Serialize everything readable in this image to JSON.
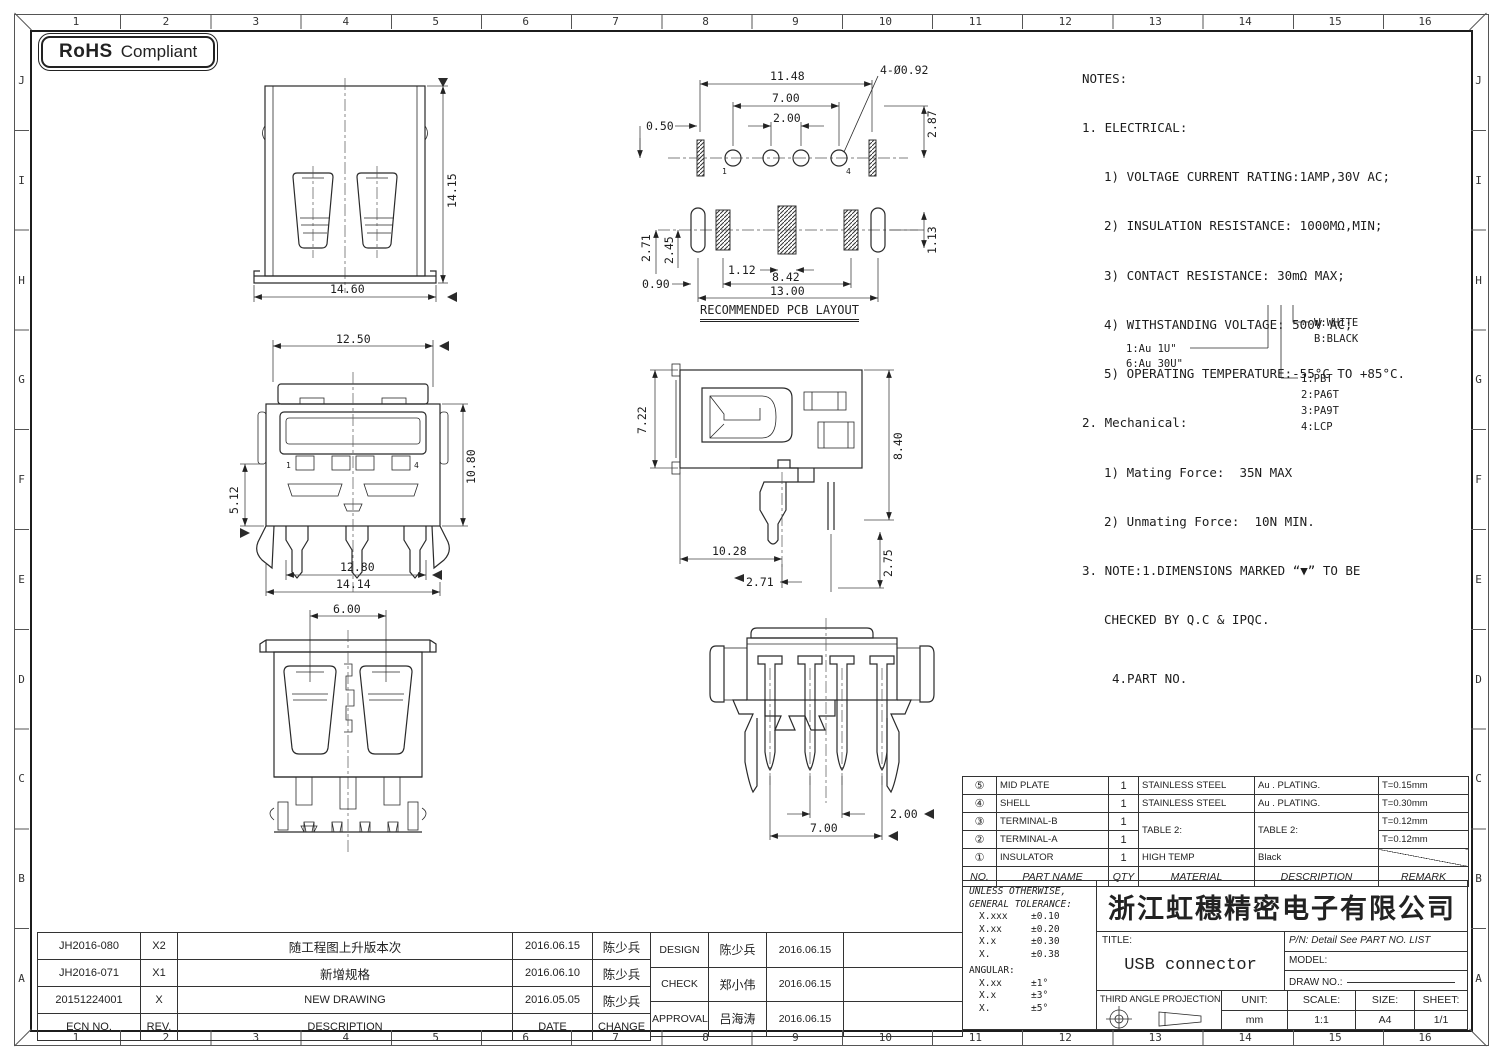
{
  "badge": {
    "bold": "RoHS",
    "rest": "Compliant"
  },
  "grid": {
    "cols": [
      "1",
      "2",
      "3",
      "4",
      "5",
      "6",
      "7",
      "8",
      "9",
      "10",
      "11",
      "12",
      "13",
      "14",
      "15",
      "16"
    ],
    "rows": [
      "J",
      "I",
      "H",
      "G",
      "F",
      "E",
      "D",
      "C",
      "B",
      "A"
    ]
  },
  "glyphs": {
    "down": "▼",
    "left": "◀",
    "right": "▶"
  },
  "notes": {
    "lines": [
      "NOTES:",
      "1. ELECTRICAL:",
      "1) VOLTAGE CURRENT RATING:1AMP,30V AC;",
      "2) INSULATION RESISTANCE: 1000MΩ,MIN;",
      "3) CONTACT RESISTANCE: 30mΩ MAX;",
      "4) WITHSTANDING VOLTAGE: 500V AC;",
      "5) OPERATING TEMPERATURE:-55°C TO +85°C.",
      "2. Mechanical:",
      "1) Mating Force:  35N MAX",
      "2) Unmating Force:  10N MIN.",
      "3. NOTE:1.DIMENSIONS MARKED “▼” TO BE",
      "CHECKED BY Q.C & IPQC.",
      "4.PART NO."
    ]
  },
  "legend": {
    "au1": "1:Au 1U\"",
    "au6": "6:Au 30U\"",
    "white": "W:WHITE",
    "black": "B:BLACK",
    "m1": "1:PBT",
    "m2": "2:PA6T",
    "m3": "3:PA9T",
    "m4": "4:LCP"
  },
  "views": {
    "front": {
      "height": "14.15",
      "width": "14.60"
    },
    "pcb": {
      "label": "RECOMMENDED PCB LAYOUT",
      "d1": "11.48",
      "d2": "7.00",
      "d3": "2.00",
      "d4": "0.50",
      "d5": "2.87",
      "callout": "4-Ø0.92",
      "d6": "2.71",
      "d7": "2.45",
      "d8": "0.90",
      "d9": "1.12",
      "d10": "8.42",
      "d11": "13.00",
      "d12": "1.13",
      "pin1": "1",
      "pin4": "4"
    },
    "front2": {
      "d1": "12.50",
      "d2": "10.80",
      "d3": "5.12",
      "d4": "12.80",
      "d5": "14.14",
      "pin1": "1",
      "pin4": "4"
    },
    "side": {
      "d1": "7.22",
      "d2": "8.40",
      "d3": "10.28",
      "d4": "2.71",
      "d5": "2.75"
    },
    "rear": {
      "d1": "6.00"
    },
    "bottom": {
      "d1": "2.00",
      "d2": "7.00"
    }
  },
  "parts_table": {
    "header": {
      "no": "NO.",
      "part_name": "PART NAME",
      "qty": "QTY",
      "material": "MATERIAL",
      "description": "DESCRIPTION",
      "remark": "REMARK"
    },
    "rows": [
      {
        "no": "⑤",
        "part_name": "MID PLATE",
        "qty": "1",
        "material": "STAINLESS STEEL",
        "description": "Au . PLATING.",
        "remark": "T=0.15mm"
      },
      {
        "no": "④",
        "part_name": "SHELL",
        "qty": "1",
        "material": "STAINLESS STEEL",
        "description": "Au . PLATING.",
        "remark": "T=0.30mm"
      },
      {
        "no": "③",
        "part_name": "TERMINAL-B",
        "qty": "1",
        "material": "TABLE 2:",
        "description": "TABLE 2:",
        "remark": "T=0.12mm"
      },
      {
        "no": "②",
        "part_name": "TERMINAL-A",
        "qty": "1",
        "remark": "T=0.12mm"
      },
      {
        "no": "①",
        "part_name": "INSULATOR",
        "qty": "1",
        "material": "HIGH TEMP",
        "description": "Black",
        "remark": ""
      }
    ]
  },
  "title_block": {
    "company": "浙江虹穗精密电子有限公司",
    "tolerance": {
      "line1": "UNLESS OTHERWISE,",
      "line2": "GENERAL TOLERANCE:",
      "rows": [
        [
          "X.xxx",
          "±0.10"
        ],
        [
          "X.xx",
          "±0.20"
        ],
        [
          "X.x",
          "±0.30"
        ],
        [
          "X.",
          "±0.38"
        ]
      ],
      "angular_label": "ANGULAR:",
      "angular_rows": [
        [
          "X.xx",
          "±1°"
        ],
        [
          "X.x",
          "±3°"
        ],
        [
          "X.",
          "±5°"
        ]
      ]
    },
    "title_label": "TITLE:",
    "title_value": "USB connector",
    "pn": "P/N: Detail See PART NO. LIST",
    "model_label": "MODEL:",
    "draw_no_label": "DRAW NO.:",
    "projection_label": "THIRD ANGLE PROJECTION",
    "unit_label": "UNIT:",
    "unit_value": "mm",
    "scale_label": "SCALE:",
    "scale_value": "1:1",
    "size_label": "SIZE:",
    "size_value": "A4",
    "sheet_label": "SHEET:",
    "sheet_value": "1/1"
  },
  "revision_table": {
    "header": {
      "ecn": "ECN NO.",
      "rev": "REV.",
      "desc": "DESCRIPTION",
      "date": "DATE",
      "change": "CHANGE"
    },
    "rows": [
      {
        "ecn": "JH2016-080",
        "rev": "X2",
        "desc": "随工程图上升版本次",
        "date": "2016.06.15",
        "change": "陈少兵"
      },
      {
        "ecn": "JH2016-071",
        "rev": "X1",
        "desc": "新增规格",
        "date": "2016.06.10",
        "change": "陈少兵"
      },
      {
        "ecn": "20151224001",
        "rev": "X",
        "desc": "NEW DRAWING",
        "date": "2016.05.05",
        "change": "陈少兵"
      }
    ]
  },
  "approval_table": {
    "rows": [
      {
        "role": "DESIGN",
        "name": "陈少兵",
        "date": "2016.06.15"
      },
      {
        "role": "CHECK",
        "name": "郑小伟",
        "date": "2016.06.15"
      },
      {
        "role": "APPROVAL",
        "name": "吕海涛",
        "date": "2016.06.15"
      }
    ]
  }
}
